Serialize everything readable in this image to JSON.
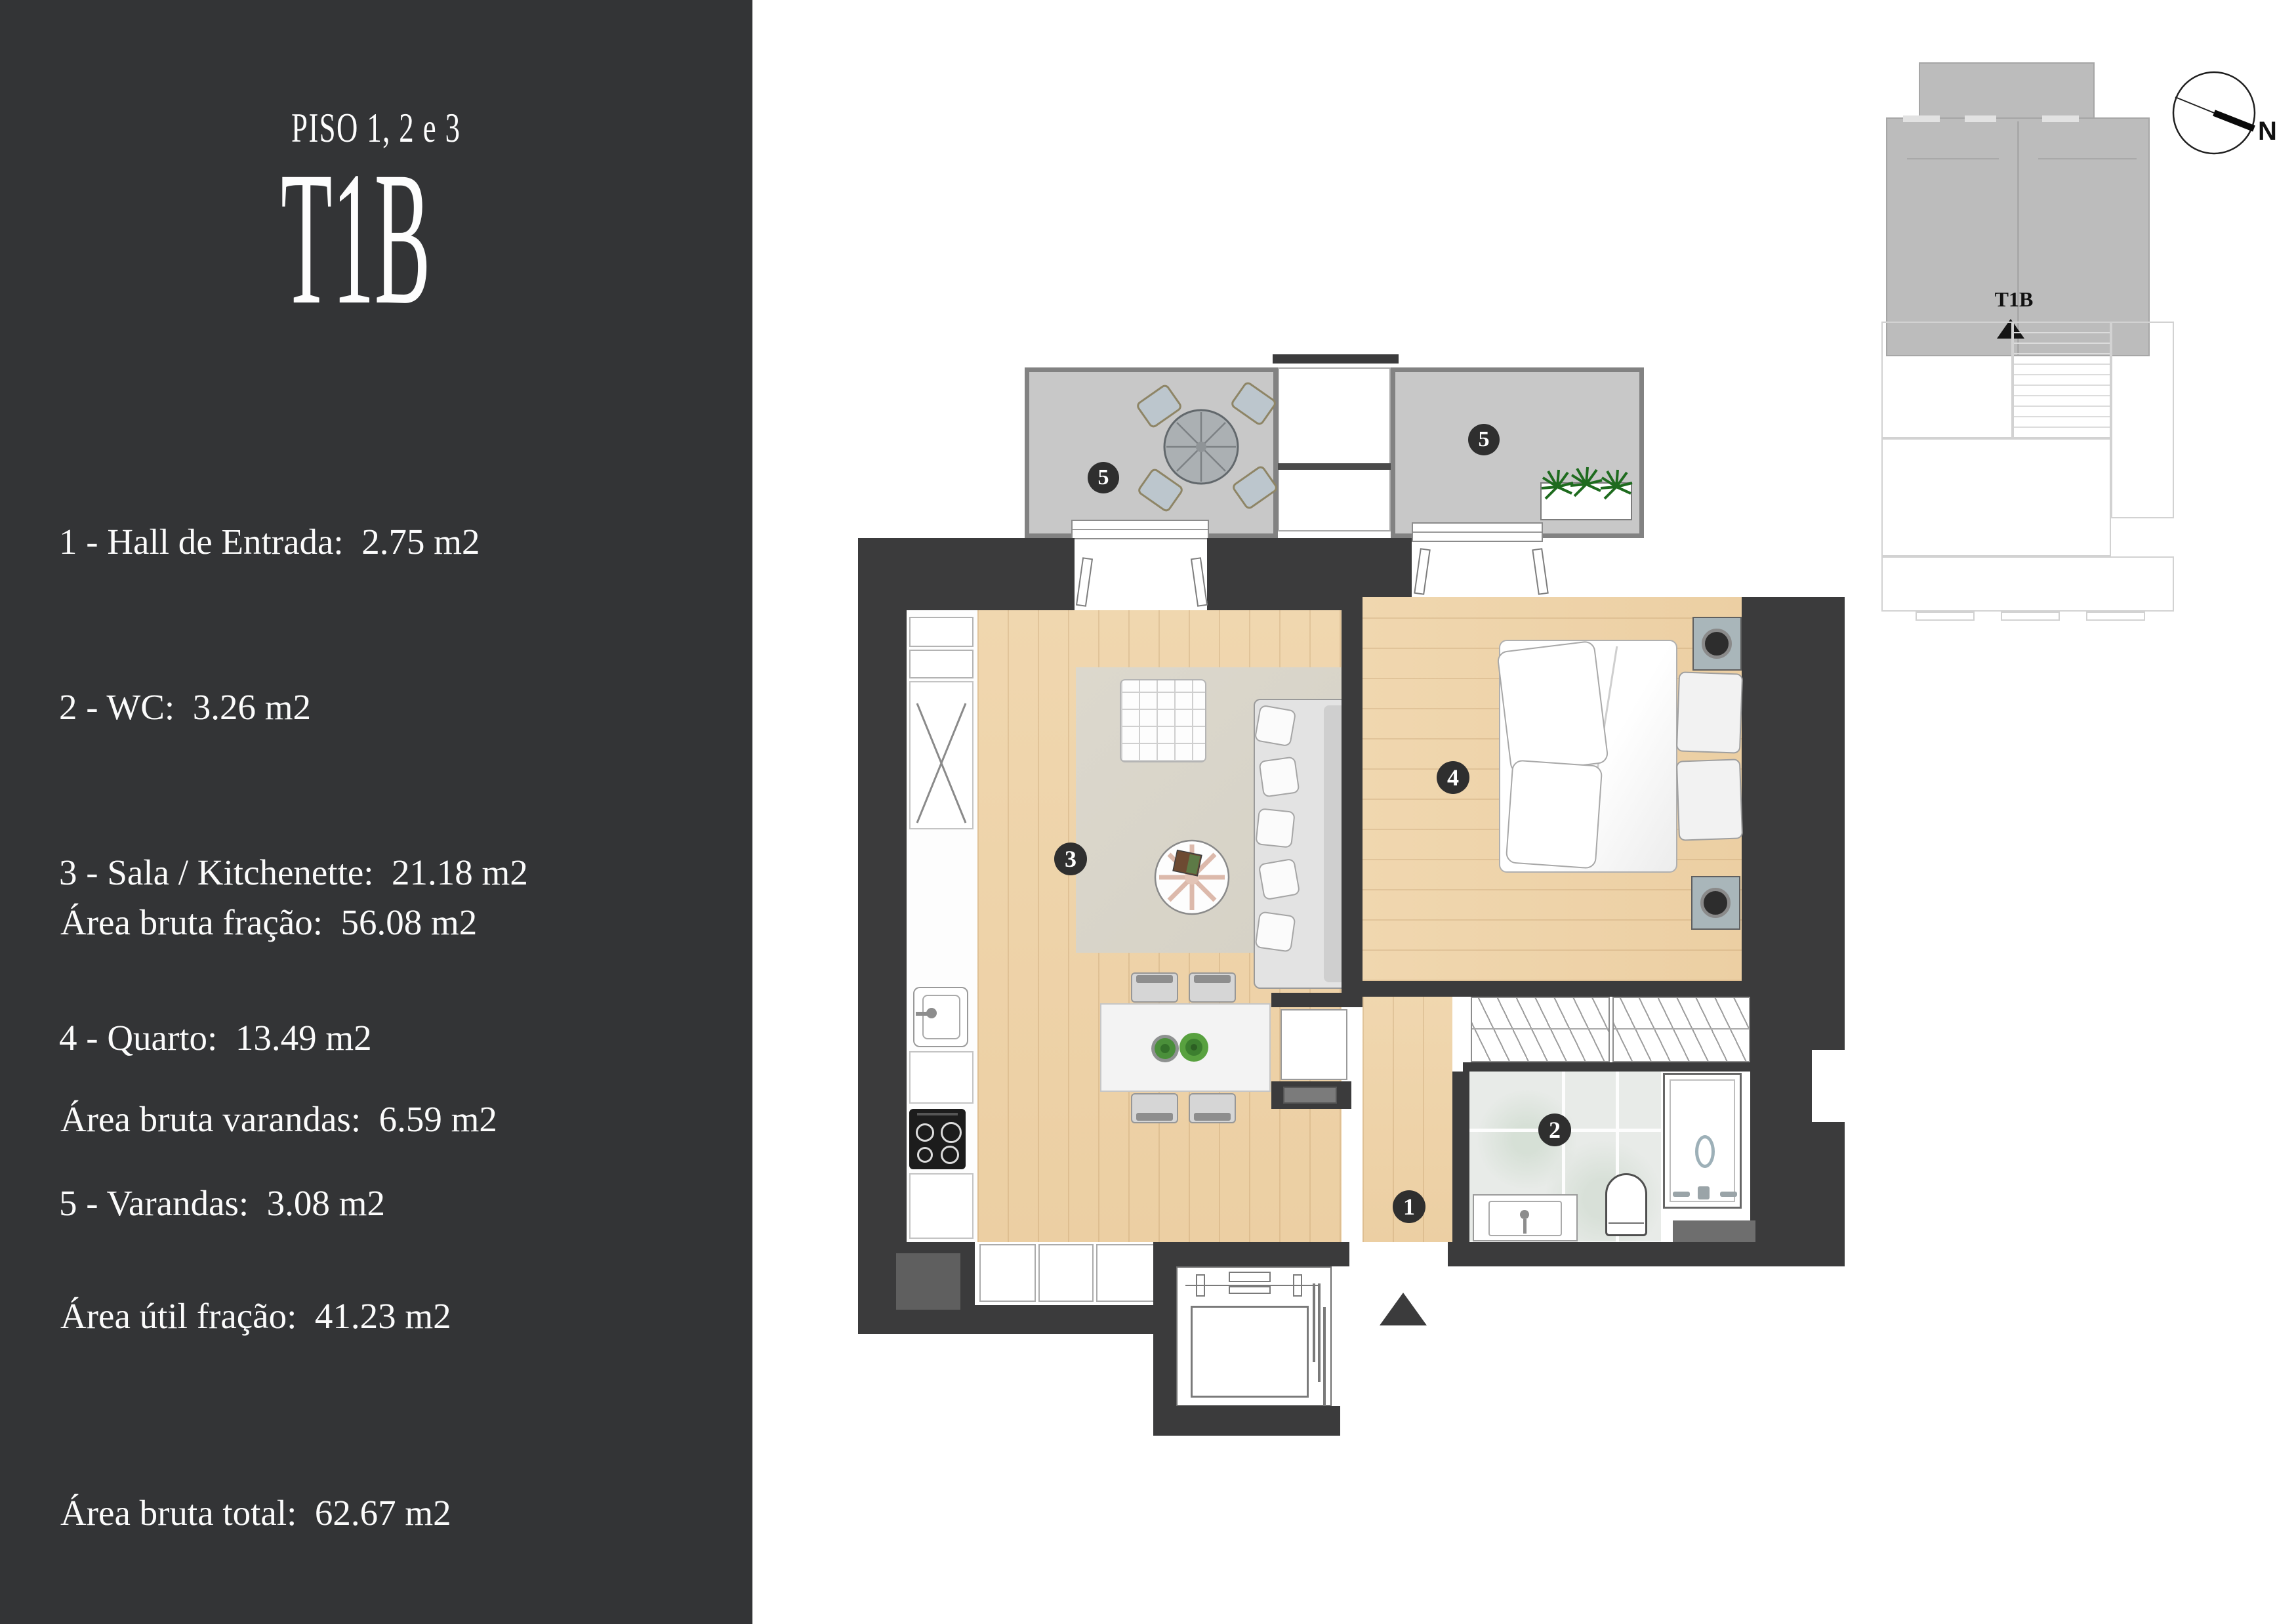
{
  "sidebar": {
    "kicker": "PISO 1, 2 e 3",
    "title": "T1B",
    "legend": [
      "1 - Hall de Entrada:  2.75 m2",
      "2 - WC:  3.26 m2",
      "3 - Sala / Kitchenette:  21.18 m2",
      "4 - Quarto:  13.49 m2",
      "5 - Varandas:  3.08 m2"
    ],
    "areas": [
      "Área bruta fração:  56.08 m2",
      "Área bruta varandas:  6.59 m2",
      "Área útil fração:  41.23 m2",
      "Área bruta total:  62.67 m2"
    ]
  },
  "plan": {
    "badges": {
      "hall": "1",
      "wc": "2",
      "living": "3",
      "bedroom": "4",
      "balcony_left": "5",
      "balcony_right": "5"
    }
  },
  "minimap": {
    "unit_label": "T1B"
  },
  "compass": {
    "north_label": "N"
  },
  "colors": {
    "sidebar_bg": "#333436",
    "wall": "#3b3b3c",
    "wood": "#eed3aa",
    "balcony": "#c8c8c8",
    "rug": "#d9d5ca",
    "marble": "#e8ebe8",
    "badge": "#2f2f2f"
  }
}
